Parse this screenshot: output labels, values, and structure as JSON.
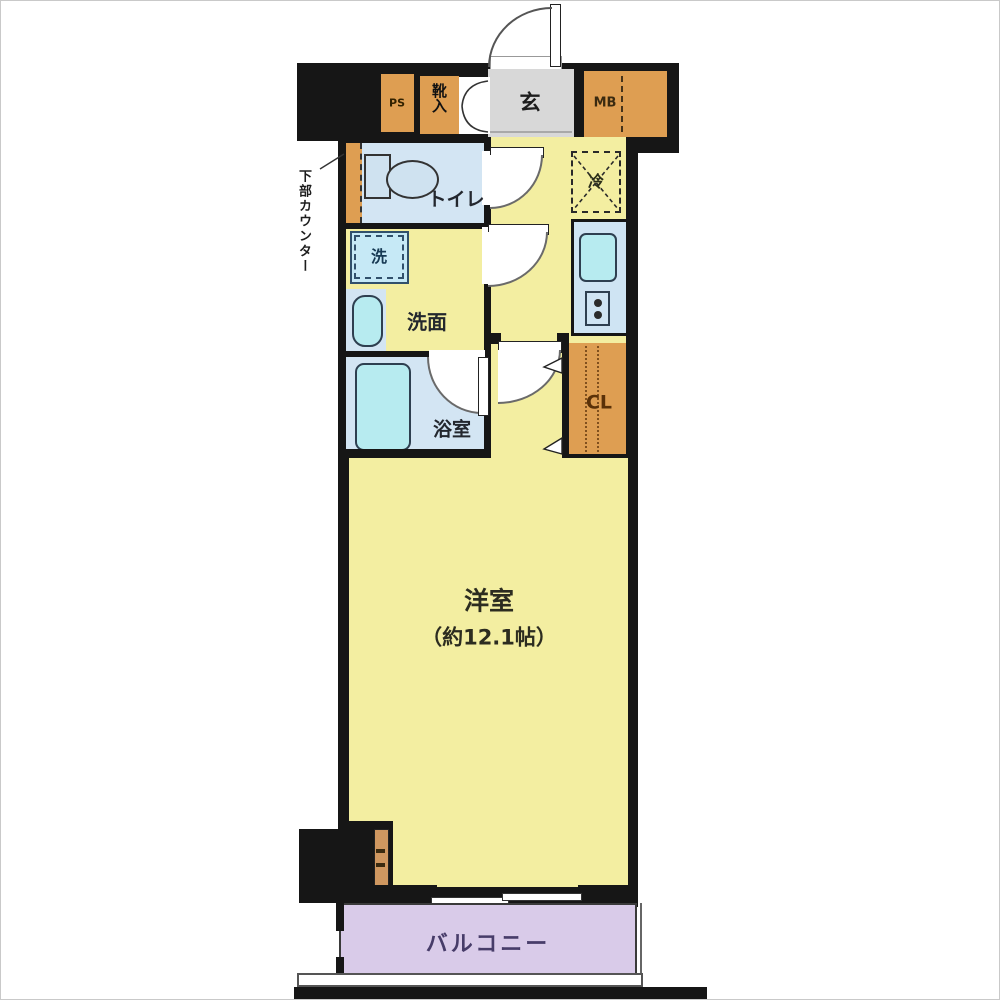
{
  "labels": {
    "ps": "PS",
    "shoe_cabinet": "靴入",
    "entrance": "玄",
    "meter_box": "MB",
    "under_counter_note": "下部カウンター",
    "toilet": "トイレ",
    "washing_machine": "洗",
    "washroom": "洗面",
    "bathroom": "浴室",
    "refrigerator": "冷",
    "closet": "CL",
    "main_room": "洋室",
    "main_room_size": "（約12.1帖）",
    "balcony": "バルコニー"
  },
  "colors": {
    "wall": "#161616",
    "room_yellow": "#f3eea1",
    "wet_area_blue": "#d3e5f3",
    "fixture_cyan": "#b7ebf0",
    "storage_orange": "#de9e52",
    "entrance_gray": "#d8d8d8",
    "balcony_purple": "#d9cbe9"
  }
}
